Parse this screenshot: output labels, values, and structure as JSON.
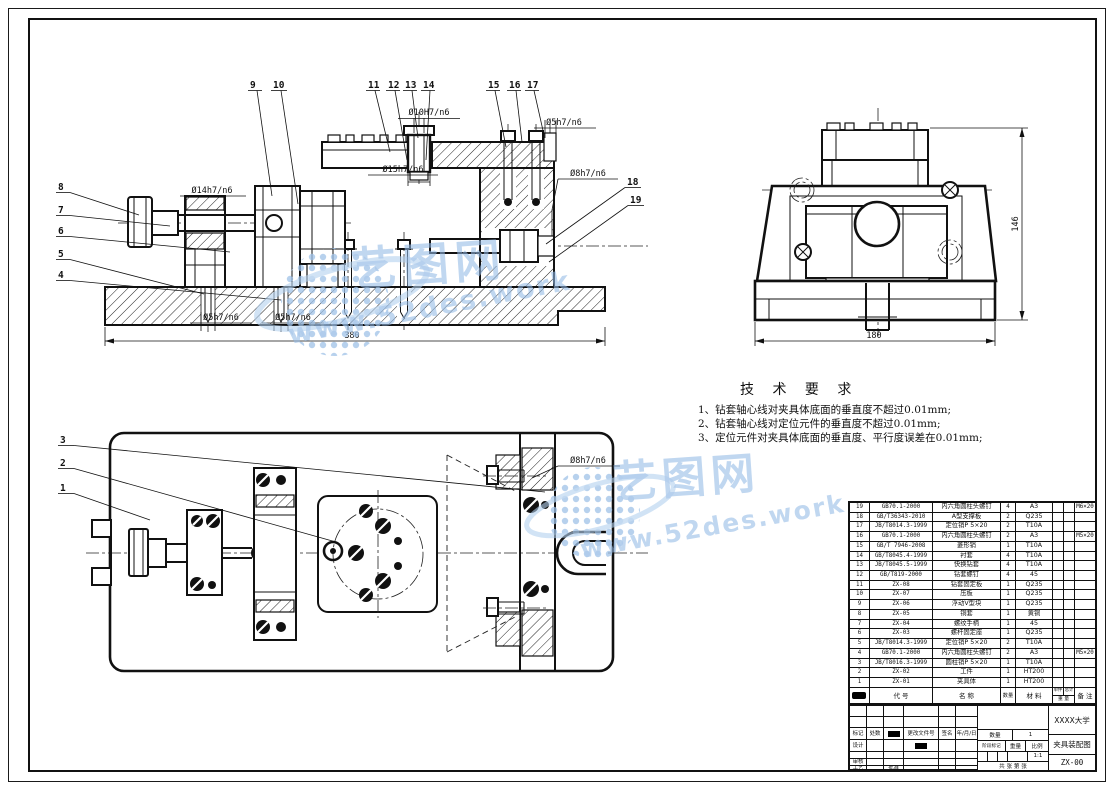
{
  "watermark": {
    "brand": "艺图网",
    "url": "www.52des.work",
    "color": "#9fc2e8"
  },
  "tech": {
    "title": "技 术 要 求",
    "items": [
      "1、钻套轴心线对夹具体底面的垂直度不超过0.01mm;",
      "2、钻套轴心线对定位元件的垂直度不超过0.01mm;",
      "3、定位元件对夹具体底面的垂直度、平行度误差在0.01mm;"
    ]
  },
  "front_view": {
    "balloons_top": [
      "9",
      "10",
      "11",
      "12",
      "13",
      "14",
      "15",
      "16",
      "17"
    ],
    "balloons_side": [
      "18",
      "19"
    ],
    "balloons_left": [
      "8",
      "7",
      "6",
      "5",
      "4"
    ],
    "dim_bush_inner": "Ø10H7/n6",
    "dim_pin_top": "Ø5h7/n6",
    "dim_bush_outer": "Ø15h7/n6",
    "dim_clamp": "Ø8h7/n6",
    "dim_rod": "Ø14h7/n6",
    "dim_pin_left": "Ø5h7/n6",
    "dim_pin_right": "Ø5h7/n6",
    "dim_width": "380"
  },
  "side_view": {
    "dim_height": "146",
    "dim_width": "180"
  },
  "plan_view": {
    "balloons": [
      "3",
      "2",
      "1"
    ],
    "dim_bush": "Ø8h7/n6"
  },
  "bom": {
    "headers": {
      "no": "序号",
      "code": "代 号",
      "name": "名 称",
      "qty": "数量",
      "material": "材 料",
      "unit": "单件",
      "total": "总计",
      "weight": "重 量",
      "remark": "备 注"
    },
    "rows": [
      {
        "no": "19",
        "code": "GB70.1-2000",
        "name": "内六角圆柱头螺钉",
        "qty": "4",
        "material": "A3",
        "unit_weight": "",
        "total_weight": "",
        "remark": "M6×20"
      },
      {
        "no": "18",
        "code": "GB/T36343-2010",
        "name": "A型支撑板",
        "qty": "2",
        "material": "Q235",
        "unit_weight": "",
        "total_weight": "",
        "remark": ""
      },
      {
        "no": "17",
        "code": "JB/T8014.3-1999",
        "name": "定位销P 5×20",
        "qty": "2",
        "material": "T10A",
        "unit_weight": "",
        "total_weight": "",
        "remark": ""
      },
      {
        "no": "16",
        "code": "GB70.1-2000",
        "name": "内六角圆柱头螺钉",
        "qty": "2",
        "material": "A3",
        "unit_weight": "",
        "total_weight": "",
        "remark": "M5×20"
      },
      {
        "no": "15",
        "code": "GB/T 7946-2008",
        "name": "菱形销",
        "qty": "1",
        "material": "T10A",
        "unit_weight": "",
        "total_weight": "",
        "remark": ""
      },
      {
        "no": "14",
        "code": "GB/T8045.4-1999",
        "name": "衬套",
        "qty": "4",
        "material": "T10A",
        "unit_weight": "",
        "total_weight": "",
        "remark": ""
      },
      {
        "no": "13",
        "code": "JB/T8045.5-1999",
        "name": "快换钻套",
        "qty": "4",
        "material": "T10A",
        "unit_weight": "",
        "total_weight": "",
        "remark": ""
      },
      {
        "no": "12",
        "code": "GB/T819-2000",
        "name": "钻套螺钉",
        "qty": "4",
        "material": "45",
        "unit_weight": "",
        "total_weight": "",
        "remark": ""
      },
      {
        "no": "11",
        "code": "ZX-08",
        "name": "钻套固定板",
        "qty": "1",
        "material": "Q235",
        "unit_weight": "",
        "total_weight": "",
        "remark": ""
      },
      {
        "no": "10",
        "code": "ZX-07",
        "name": "压板",
        "qty": "1",
        "material": "Q235",
        "unit_weight": "",
        "total_weight": "",
        "remark": ""
      },
      {
        "no": "9",
        "code": "ZX-06",
        "name": "浮动V型块",
        "qty": "1",
        "material": "Q235",
        "unit_weight": "",
        "total_weight": "",
        "remark": ""
      },
      {
        "no": "8",
        "code": "ZX-05",
        "name": "铜套",
        "qty": "1",
        "material": "黄铜",
        "unit_weight": "",
        "total_weight": "",
        "remark": ""
      },
      {
        "no": "7",
        "code": "ZX-04",
        "name": "螺纹手柄",
        "qty": "1",
        "material": "45",
        "unit_weight": "",
        "total_weight": "",
        "remark": ""
      },
      {
        "no": "6",
        "code": "ZX-03",
        "name": "螺杆固定座",
        "qty": "1",
        "material": "Q235",
        "unit_weight": "",
        "total_weight": "",
        "remark": ""
      },
      {
        "no": "5",
        "code": "JB/T8014.3-1999",
        "name": "定位销P 5×20",
        "qty": "2",
        "material": "T10A",
        "unit_weight": "",
        "total_weight": "",
        "remark": ""
      },
      {
        "no": "4",
        "code": "GB70.1-2000",
        "name": "内六角圆柱头螺钉",
        "qty": "2",
        "material": "A3",
        "unit_weight": "",
        "total_weight": "",
        "remark": "M5×20"
      },
      {
        "no": "3",
        "code": "JB/T8016.3-1999",
        "name": "圆柱销P 5×20",
        "qty": "1",
        "material": "T10A",
        "unit_weight": "",
        "total_weight": "",
        "remark": ""
      },
      {
        "no": "2",
        "code": "ZX-02",
        "name": "工件",
        "qty": "1",
        "material": "HT200",
        "unit_weight": "",
        "total_weight": "",
        "remark": ""
      },
      {
        "no": "1",
        "code": "ZX-01",
        "name": "夹具体",
        "qty": "1",
        "material": "HT200",
        "unit_weight": "",
        "total_weight": "",
        "remark": ""
      }
    ]
  },
  "title_block": {
    "school": "XXXX大学",
    "drawing_title": "夹具装配图",
    "drawing_no": "ZX-00",
    "mark_label": "标记",
    "count_label": "处数",
    "change_label": "更改文件号",
    "sign_label": "签名",
    "date_label": "年/月/日",
    "design_label": "设计",
    "check_label": "审核",
    "process_label": "工艺",
    "approve_label": "批准",
    "qty_label": "数量",
    "qty_value": "1",
    "stage_label": "阶段标记",
    "weight_label": "重量",
    "scale_label": "比例",
    "scale_value": "1:1",
    "sheet_label": "共  张  第  张"
  }
}
